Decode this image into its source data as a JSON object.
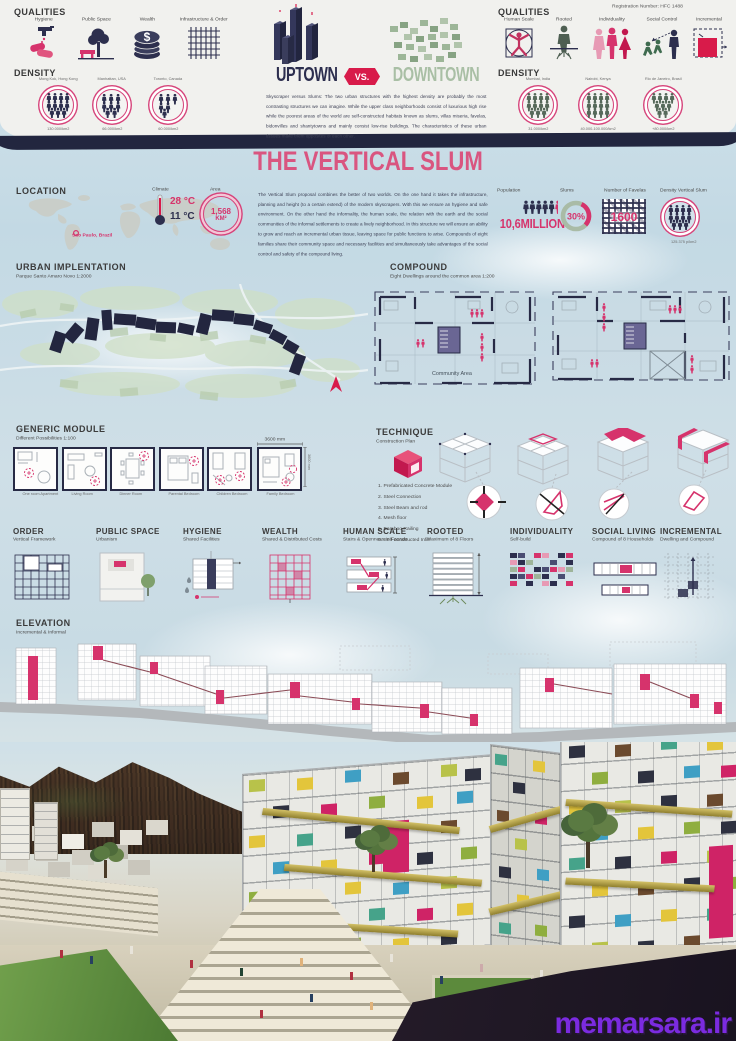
{
  "registration_label": "Registration Number: HFC 1488",
  "header_left": {
    "qualities_title": "QUALITIES",
    "items": [
      "Hygiene",
      "Public Space",
      "Wealth",
      "Infrastructure & Order"
    ],
    "density_title": "DENSITY",
    "cities": [
      {
        "name": "Mong Kok, Hong Kong",
        "density": "130.000/km2"
      },
      {
        "name": "Manhattan, USA",
        "density": "66.000/km2"
      },
      {
        "name": "Toronto, Canada",
        "density": "60.000/km2"
      }
    ]
  },
  "header_center": {
    "uptown_label": "UPTOWN",
    "vs_label": "VS.",
    "downtown_label": "DOWNTOWN",
    "paragraph": "Skyscraper versus Slums: The two urban structures with the highest density are probably the most contrasting structures we can imagine. While the upper class neighborhoods consist of luxurious high rise while the poorest areas of the world are self-constructed habitats known as slums, villas miseria, favelas, bidonvilles and shantytowns and mainly consist low-rise buildings. The characteristics of these urban tissues make them opposites of each other."
  },
  "header_right": {
    "qualities_title": "QUALITIES",
    "items": [
      "Human Scale",
      "Rooted",
      "Individuality",
      "Social Control",
      "Incremental"
    ],
    "density_title": "DENSITY",
    "cities": [
      {
        "name": "Mumbai, India",
        "density": "31.000/km2"
      },
      {
        "name": "Nairobi, Kenya",
        "density": "40.000-100.000/km2"
      },
      {
        "name": "Rio de Janeiro, Brasil",
        "density": "+80.000/km2"
      }
    ]
  },
  "main_title": "THE VERTICAL SLUM",
  "location": {
    "title": "LOCATION",
    "marker": "Sao Paulo, Brazil",
    "climate_label": "Climate",
    "temp_high": "28 °C",
    "temp_low": "11 °C",
    "area_label": "Area",
    "area_value": "1,568",
    "area_unit": "KM²"
  },
  "intro_paragraph": "The Vertical Slum proposal combines the better of two worlds. On the one hand it takes the infrastructure, planning and height (to a certain extend) of the modern skyscrapers. With this we ensure an hygiene and safe environment. On the other hand the informality, the human scale, the relation with the earth and the social communities of the informal settlements to create a lively neighborhood. In this structure we will ensure an ability to grow and reach an incremental urban tissue, leaving space for public functions to arise. Compounds of eight families share their community space and necessary facilities and simultaneously take advantages of the social control and safety of the compound living.",
  "stats": {
    "population_label": "Population",
    "population_value": "10,6MILLION",
    "slums_label": "Slums",
    "slums_value": "30%",
    "favelas_label": "Number of Favelas",
    "favelas_value": "1600",
    "density_label": "Density Vertical Slum",
    "density_value": "125.375 p/km2"
  },
  "urban": {
    "title": "URBAN IMPLENTATION",
    "subtitle": "Parque Santo Amaro Novo 1:2000"
  },
  "compound": {
    "title": "COMPOUND",
    "subtitle": "Eight Dwellings around the common area 1:200",
    "community_label": "Community Area"
  },
  "generic_module": {
    "title": "GENERIC MODULE",
    "subtitle": "Different Possibilities 1:100",
    "modules": [
      "One room Apartment",
      "Living Room",
      "Dinner Room",
      "Parental Bedroom",
      "Children Bedroom",
      "Family Bedroom"
    ],
    "dim_h": "3600 mm",
    "dim_v": "3600 mm"
  },
  "technique": {
    "title": "TECHNIQUE",
    "subtitle": "Construction Plan",
    "steps": [
      "1. Prefabricated Concrete Module",
      "2. Steel Connection",
      "3. Steel Beam and rod",
      "4. Mesh floor",
      "5. Bamboo Railing",
      "6. Self-constructed Infill"
    ]
  },
  "principles": [
    {
      "title": "ORDER",
      "subtitle": "Vertical Framework"
    },
    {
      "title": "PUBLIC SPACE",
      "subtitle": "Urbanism"
    },
    {
      "title": "HYGIENE",
      "subtitle": "Shared Facilities"
    },
    {
      "title": "WEALTH",
      "subtitle": "Shared & Distributed Costs"
    },
    {
      "title": "HUMAN SCALE",
      "subtitle": "Stairs & Openness in Facade"
    },
    {
      "title": "ROOTED",
      "subtitle": "Maximum of 8 Floors"
    },
    {
      "title": "INDIVIDUALITY",
      "subtitle": "Self-build"
    },
    {
      "title": "SOCIAL LIVING",
      "subtitle": "Compound of 8 Households"
    },
    {
      "title": "INCREMENTAL",
      "subtitle": "Dwelling and Compound"
    }
  ],
  "elevation": {
    "title": "ELEVATION",
    "subtitle": "Incremental & Informal"
  },
  "watermark": "memarsara.ir",
  "colors": {
    "accent_pink": "#d6336c",
    "accent_red": "#d81b4a",
    "navy": "#2d2f4e",
    "downtown_green": "#a6bfa2",
    "watermark_purple": "#7b2be0"
  }
}
